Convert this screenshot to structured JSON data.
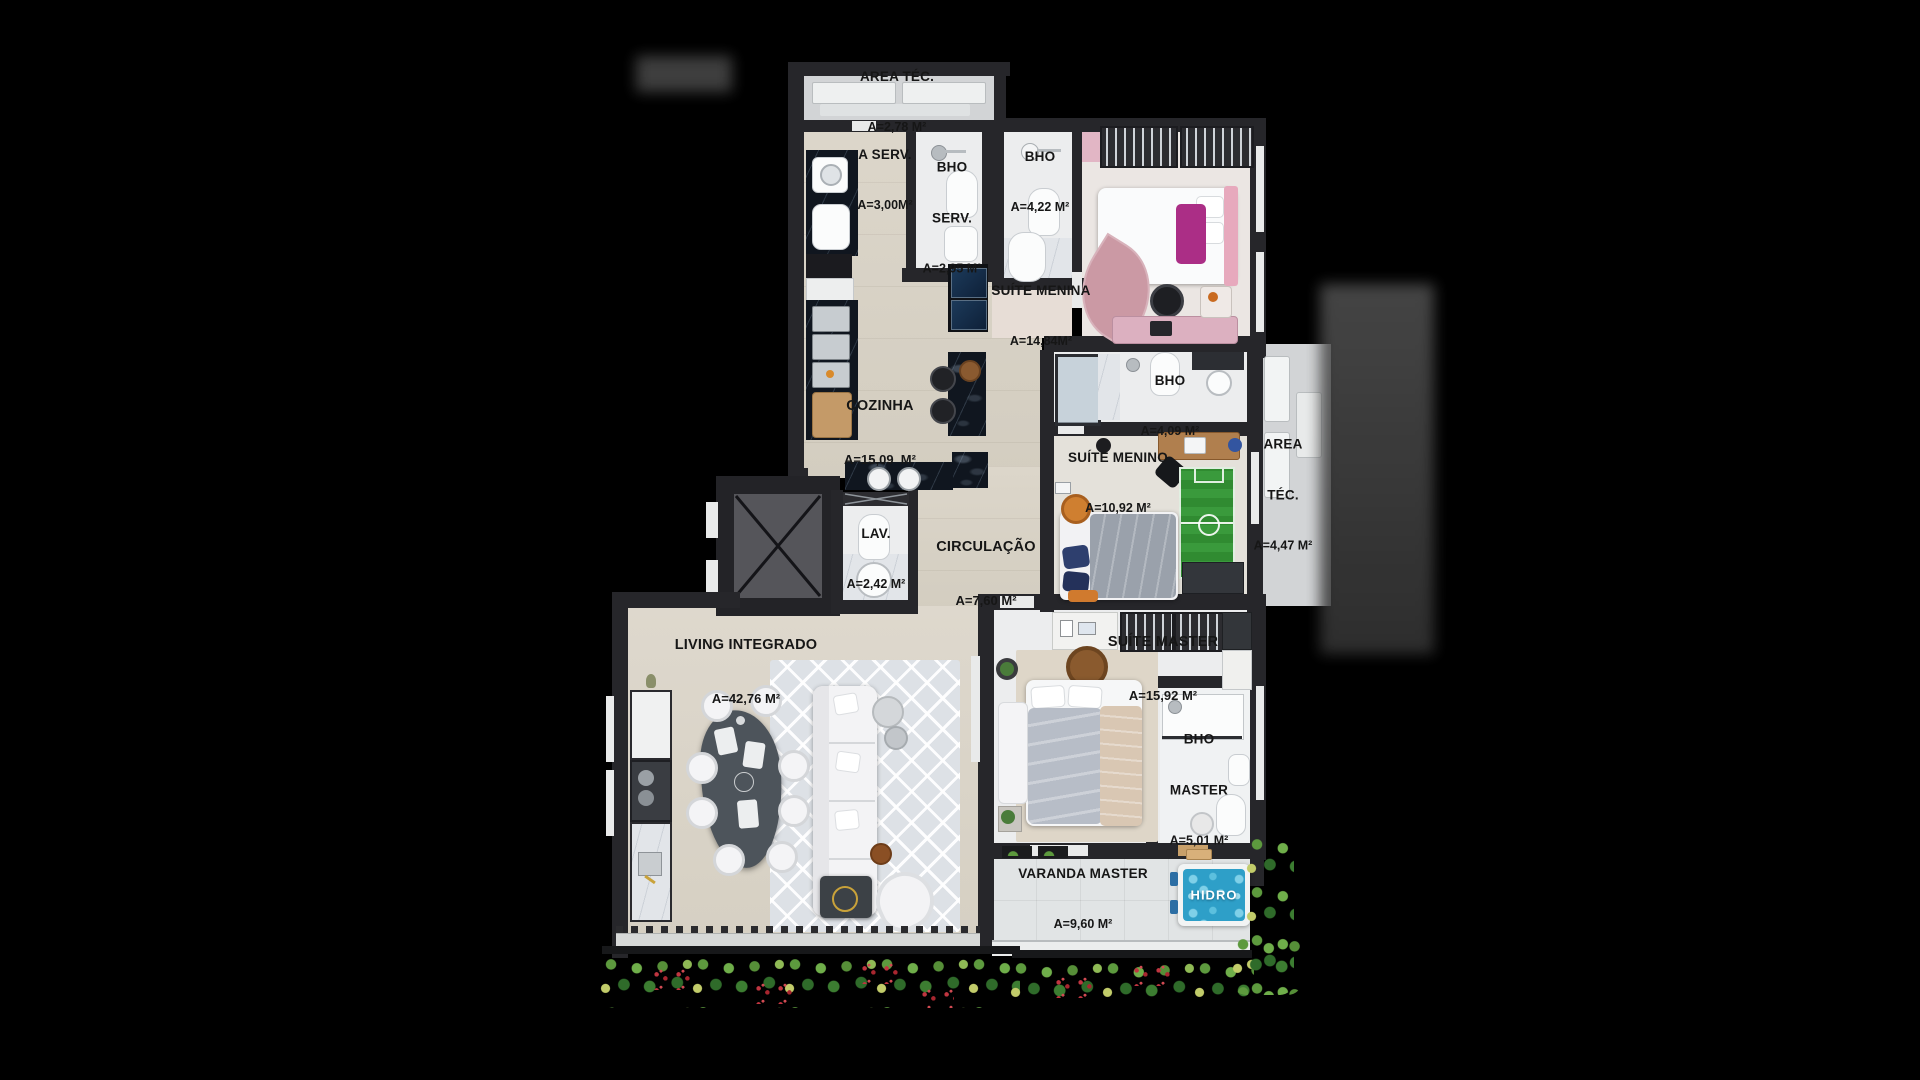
{
  "page": {
    "background": "#000000",
    "type": "apartment-floorplan-render"
  },
  "rooms": {
    "area_tec_top": {
      "name": "AREA TÉC.",
      "area": "A=2,78 M²"
    },
    "a_serv": {
      "name": "A SERV.",
      "area": "A=3,00M²"
    },
    "bho_serv": {
      "name1": "BHO",
      "name2": "SERV.",
      "area": "A=2,95 M²"
    },
    "bho_social": {
      "name": "BHO",
      "area": "A=4,22 M²"
    },
    "suite_menina": {
      "name": "SUÍTE MENINA",
      "area": "A=14,84M²"
    },
    "cozinha": {
      "name": "COZINHA",
      "area": "A=15,09  M²"
    },
    "bho_menino": {
      "name": "BHO",
      "area": "A=4,09 M²"
    },
    "suite_menino": {
      "name": "SUÍTE MENINO",
      "area": "A=10,92 M²"
    },
    "area_tec_right": {
      "name1": "AREA",
      "name2": "TÉC.",
      "area": "A=4,47 M²"
    },
    "lav": {
      "name": "LAV.",
      "area": "A=2,42 M²"
    },
    "circulacao": {
      "name": "CIRCULAÇÃO",
      "area": "A=7,60 M²"
    },
    "living": {
      "name": "LIVING INTEGRADO",
      "area": "A=42,76 M²"
    },
    "suite_master": {
      "name": "SUÍTE MASTER",
      "area": "A=15,92 M²"
    },
    "bho_master": {
      "name1": "BHO",
      "name2": "MASTER",
      "area": "A=5,01 M²"
    },
    "varanda_master": {
      "name": "VARANDA MASTER",
      "area": "A=9,60 M²"
    },
    "hidro": {
      "label": "HIDRO"
    }
  },
  "colors": {
    "wall": "#26262a",
    "floor_beige": "#d8d2c6",
    "hidro_water": "#2e9fc8",
    "soccer_green": "#3a9a3c",
    "label_text": "#161616"
  }
}
